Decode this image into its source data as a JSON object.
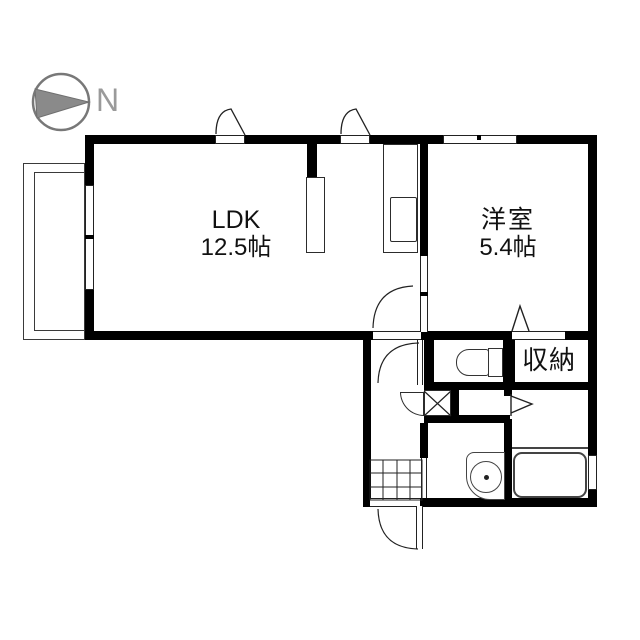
{
  "compass": {
    "label": "N"
  },
  "rooms": {
    "ldk": {
      "name": "LDK",
      "size": "12.5帖"
    },
    "western_room": {
      "name": "洋室",
      "size": "5.4帖"
    },
    "storage": {
      "name": "収納"
    }
  },
  "fixtures": {
    "toilet": "toilet-icon",
    "bathtub": "bathtub-icon",
    "wash_basin": "wash-basin-icon",
    "kitchen_counter": "kitchen-counter-icon",
    "washing_machine_box": "washing-machine-box-icon",
    "entrance_tile_grid": "entrance-tile-grid-icon",
    "balcony": "balcony-outline-icon",
    "north_arrow": "north-arrow-icon"
  },
  "colors": {
    "wall": "#000000",
    "thin_line": "#222222",
    "fixture_line": "#444444",
    "compass_gray": "#8a8a8a",
    "compass_text": "#9a9a9a",
    "background": "#ffffff"
  }
}
